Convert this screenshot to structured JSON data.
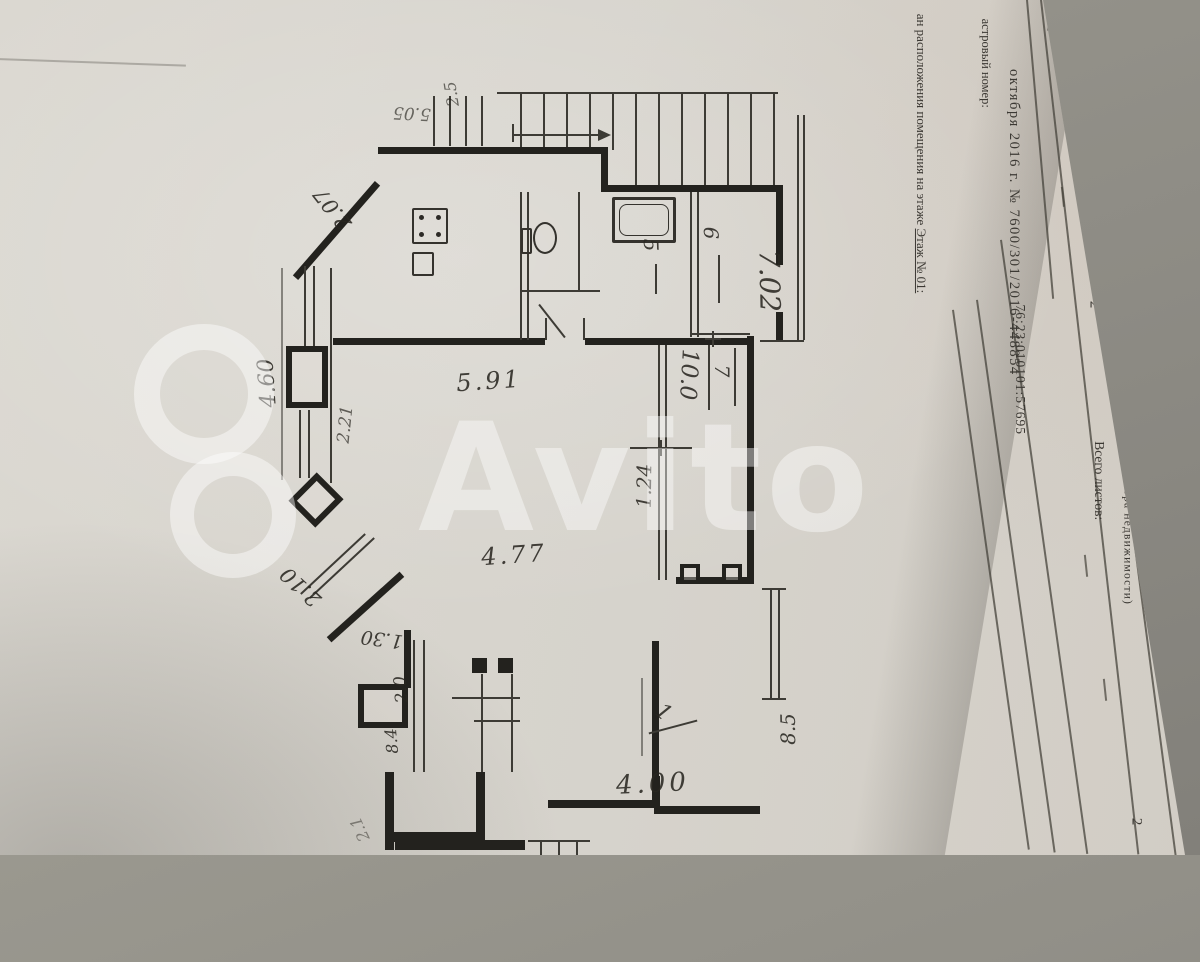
{
  "photo": {
    "background": "#8d8b84",
    "paper": "#d8d5ce"
  },
  "watermark": {
    "brand": "Avito"
  },
  "document": {
    "title": "КАДАСТРОВЫЙ ПАСПОРТ",
    "subtitle": "помещения",
    "note": "(выписка из государственного кадастра недвижимости)",
    "sheet_label": "т №",
    "sheet_value": "2",
    "total_label": "Всего листов:",
    "total_value": "2",
    "reg_line": "октября 2016 г. № 7600/301/2016-448854",
    "cadastral_label": "астровый номер:",
    "cadastral_value": "76:23:010101:57695",
    "floor_prefix": "ан расположения помещения на этаже ",
    "floor_value": "Этаж № 01:",
    "page_number": "2"
  },
  "plan": {
    "fixtures": [
      "stairs",
      "stove",
      "toilet",
      "bathtub"
    ],
    "labels": [
      {
        "text": "2.07"
      },
      {
        "text": "5.05"
      },
      {
        "text": "2.5"
      },
      {
        "text": "4.60"
      },
      {
        "text": "2.21"
      },
      {
        "text": "5.91"
      },
      {
        "text": "7.02"
      },
      {
        "text": "10.0"
      },
      {
        "text": "7"
      },
      {
        "text": "6"
      },
      {
        "text": "5"
      },
      {
        "text": "1.24"
      },
      {
        "text": "4.77"
      },
      {
        "text": "2.10"
      },
      {
        "text": "1.30"
      },
      {
        "text": "2.0"
      },
      {
        "text": "8.4"
      },
      {
        "text": "4.00"
      },
      {
        "text": "1"
      },
      {
        "text": "8.5"
      },
      {
        "text": "2.1"
      }
    ]
  }
}
